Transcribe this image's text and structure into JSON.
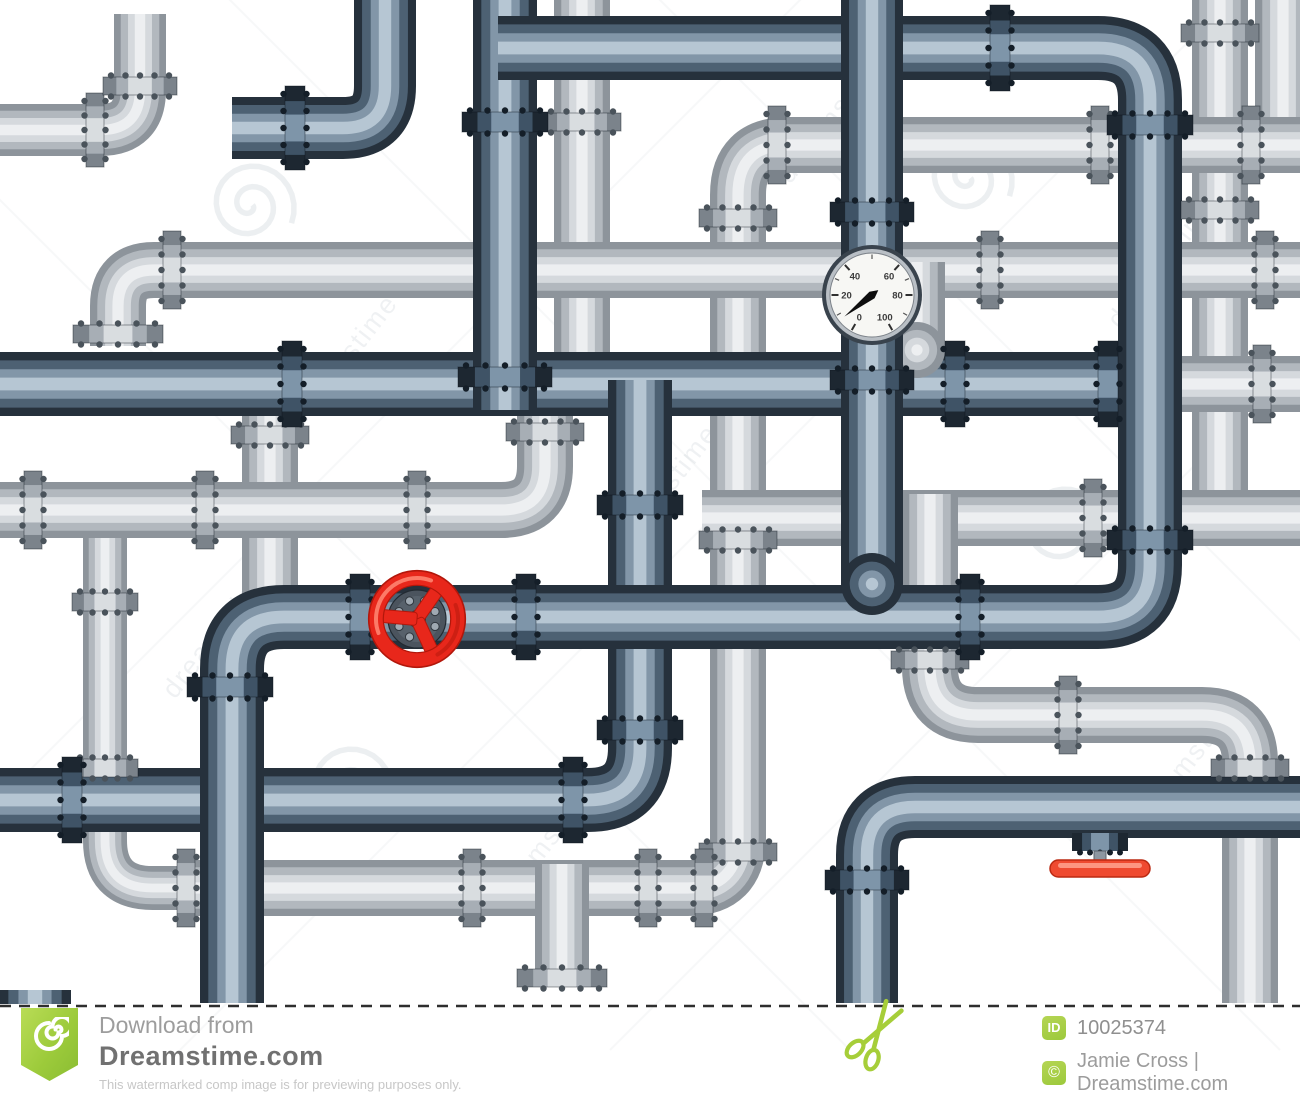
{
  "page_title": "Plumbing pipe maze stock illustration preview",
  "footer": {
    "download_from": "Download from",
    "site_name": "Dreamstime.com",
    "disclaimer": "This watermarked comp image is for previewing purposes only.",
    "id_label": "ID",
    "image_id": "10025374",
    "copyright_symbol": "©",
    "credit": "Jamie Cross | Dreamstime.com"
  },
  "watermark": {
    "text": "dreamstime",
    "color": "#6e8090",
    "text_instances": [
      {
        "x": 300,
        "y": 430,
        "rot": -52
      },
      {
        "x": 175,
        "y": 700,
        "rot": -52
      },
      {
        "x": 1120,
        "y": 330,
        "rot": -52
      },
      {
        "x": 790,
        "y": 185,
        "rot": -52
      },
      {
        "x": 500,
        "y": 915,
        "rot": -52
      },
      {
        "x": 1145,
        "y": 830,
        "rot": -52
      },
      {
        "x": 620,
        "y": 560,
        "rot": -52
      }
    ],
    "spirals": [
      {
        "x": 250,
        "y": 205
      },
      {
        "x": 968,
        "y": 178
      },
      {
        "x": 348,
        "y": 788
      },
      {
        "x": 1062,
        "y": 528
      }
    ],
    "diag_lines": 6
  },
  "palette": {
    "pipe": {
      "D": [
        {
          "f": 1,
          "c": "#26313c"
        },
        {
          "f": 0.74,
          "c": "#4d6173"
        },
        {
          "f": 0.46,
          "c": "#8296a8"
        },
        {
          "f": 0.2,
          "c": "#b6c6d3"
        }
      ],
      "L": [
        {
          "f": 1,
          "c": "#8d949b"
        },
        {
          "f": 0.74,
          "c": "#b2b8be"
        },
        {
          "f": 0.46,
          "c": "#d5d9dd"
        },
        {
          "f": 0.2,
          "c": "#edeff1"
        }
      ]
    },
    "flange": {
      "D": {
        "bands": [
          "#1d2731",
          "#3f5366",
          "#7e95a9"
        ],
        "bolt": "#141e28"
      },
      "L": {
        "bands": [
          "#7b838b",
          "#a7aeb5",
          "#d9dde0"
        ],
        "bolt": "#4a535b"
      }
    }
  },
  "illustration": {
    "pipes": [
      {
        "n": "light-vert-582",
        "t": "L",
        "w": 56,
        "pts": [
          [
            582,
            -30
          ],
          [
            582,
            360
          ]
        ]
      },
      {
        "n": "light-vert-1220",
        "t": "L",
        "w": 56,
        "pts": [
          [
            1220,
            -30
          ],
          [
            1220,
            512
          ]
        ]
      },
      {
        "n": "light-vert-corner-tr",
        "t": "L",
        "w": 56,
        "pts": [
          [
            1283,
            -30
          ],
          [
            1283,
            170
          ]
        ]
      },
      {
        "n": "light-topleft-elbow",
        "t": "L",
        "w": 52,
        "pts": [
          [
            0,
            130
          ],
          [
            140,
            130
          ],
          [
            140,
            14
          ]
        ],
        "r": 40
      },
      {
        "n": "light-hook-left",
        "t": "L",
        "w": 44,
        "pts": [
          [
            105,
            496
          ],
          [
            105,
            888
          ],
          [
            200,
            888
          ]
        ],
        "r": 52
      },
      {
        "n": "light-big-c",
        "t": "L",
        "w": 56,
        "pts": [
          [
            1300,
            145
          ],
          [
            738,
            145
          ],
          [
            738,
            888
          ],
          [
            186,
            888
          ]
        ],
        "r": 50
      },
      {
        "n": "light-h270",
        "t": "L",
        "w": 56,
        "pts": [
          [
            118,
            346
          ],
          [
            118,
            270
          ],
          [
            1300,
            270
          ]
        ],
        "r": 36
      },
      {
        "n": "light-vert-270",
        "t": "L",
        "w": 56,
        "pts": [
          [
            270,
            410
          ],
          [
            270,
            645
          ]
        ]
      },
      {
        "n": "light-h510-elbow-up",
        "t": "L",
        "w": 56,
        "pts": [
          [
            0,
            510
          ],
          [
            545,
            510
          ],
          [
            545,
            404
          ]
        ],
        "r": 44
      },
      {
        "n": "light-h518-right",
        "t": "L",
        "w": 56,
        "pts": [
          [
            702,
            518
          ],
          [
            1300,
            518
          ]
        ]
      },
      {
        "n": "light-s-route",
        "t": "L",
        "w": 56,
        "pts": [
          [
            930,
            494
          ],
          [
            930,
            715
          ],
          [
            1250,
            715
          ],
          [
            1250,
            1003
          ]
        ],
        "r": 48
      },
      {
        "n": "light-stub-down",
        "t": "L",
        "w": 54,
        "pts": [
          [
            562,
            864
          ],
          [
            562,
            970
          ]
        ]
      },
      {
        "n": "light-h384-right",
        "t": "L",
        "w": 56,
        "pts": [
          [
            1146,
            384
          ],
          [
            1300,
            384
          ]
        ]
      },
      {
        "n": "dark-main-384",
        "t": "D",
        "w": 64,
        "pts": [
          [
            0,
            384
          ],
          [
            1152,
            384
          ]
        ]
      },
      {
        "n": "dark-vert640-h800",
        "t": "D",
        "w": 64,
        "pts": [
          [
            640,
            380
          ],
          [
            640,
            800
          ],
          [
            0,
            800
          ]
        ],
        "r": 52
      },
      {
        "n": "light-stub-dome-917",
        "t": "L",
        "w": 56,
        "pts": [
          [
            917,
            262
          ],
          [
            917,
            350
          ]
        ],
        "dome": [
          917,
          350
        ]
      },
      {
        "n": "dark-vert-505",
        "t": "D",
        "w": 64,
        "pts": [
          [
            505,
            -30
          ],
          [
            505,
            410
          ]
        ]
      },
      {
        "n": "dark-grand-route",
        "t": "D",
        "w": 64,
        "pts": [
          [
            498,
            48
          ],
          [
            1150,
            48
          ],
          [
            1150,
            617
          ],
          [
            232,
            617
          ],
          [
            232,
            1003
          ]
        ],
        "r": 52
      },
      {
        "n": "dark-gauge-pipe",
        "t": "D",
        "w": 62,
        "pts": [
          [
            872,
            -40
          ],
          [
            872,
            584
          ]
        ],
        "dome": [
          872,
          584
        ]
      },
      {
        "n": "dark-topleft-elbow",
        "t": "D",
        "w": 62,
        "pts": [
          [
            385,
            -30
          ],
          [
            385,
            128
          ],
          [
            232,
            128
          ]
        ],
        "r": 42
      },
      {
        "n": "dark-bottom-right",
        "t": "D",
        "w": 62,
        "pts": [
          [
            867,
            1003
          ],
          [
            867,
            807
          ],
          [
            1300,
            807
          ]
        ],
        "r": 48
      },
      {
        "n": "dark-pipe-end-bl",
        "t": "D",
        "w": 72,
        "pts": [
          [
            35,
            990
          ],
          [
            35,
            1004
          ]
        ]
      }
    ],
    "flanges": [
      {
        "x": 95,
        "y": 130,
        "o": "h",
        "t": "L",
        "pw": 52
      },
      {
        "x": 140,
        "y": 86,
        "o": "v",
        "t": "L",
        "pw": 52
      },
      {
        "x": 582,
        "y": 122,
        "o": "v",
        "t": "L",
        "pw": 56
      },
      {
        "x": 777,
        "y": 145,
        "o": "h",
        "t": "L",
        "pw": 56
      },
      {
        "x": 1100,
        "y": 145,
        "o": "h",
        "t": "L",
        "pw": 56
      },
      {
        "x": 1251,
        "y": 145,
        "o": "h",
        "t": "L",
        "pw": 56
      },
      {
        "x": 1220,
        "y": 33,
        "o": "v",
        "t": "L",
        "pw": 56
      },
      {
        "x": 1220,
        "y": 210,
        "o": "v",
        "t": "L",
        "pw": 56
      },
      {
        "x": 172,
        "y": 270,
        "o": "h",
        "t": "L",
        "pw": 56
      },
      {
        "x": 990,
        "y": 270,
        "o": "h",
        "t": "L",
        "pw": 56
      },
      {
        "x": 1265,
        "y": 270,
        "o": "h",
        "t": "L",
        "pw": 56
      },
      {
        "x": 738,
        "y": 218,
        "o": "v",
        "t": "L",
        "pw": 56
      },
      {
        "x": 118,
        "y": 334,
        "o": "v",
        "t": "L",
        "pw": 56,
        "b": 34
      },
      {
        "x": 738,
        "y": 540,
        "o": "v",
        "t": "L",
        "pw": 56
      },
      {
        "x": 738,
        "y": 852,
        "o": "v",
        "t": "L",
        "pw": 56
      },
      {
        "x": 105,
        "y": 602,
        "o": "v",
        "t": "L",
        "pw": 44
      },
      {
        "x": 105,
        "y": 768,
        "o": "v",
        "t": "L",
        "pw": 44
      },
      {
        "x": 186,
        "y": 888,
        "o": "h",
        "t": "L",
        "pw": 56
      },
      {
        "x": 472,
        "y": 888,
        "o": "h",
        "t": "L",
        "pw": 56
      },
      {
        "x": 648,
        "y": 888,
        "o": "h",
        "t": "L",
        "pw": 56
      },
      {
        "x": 704,
        "y": 888,
        "o": "h",
        "t": "L",
        "pw": 56
      },
      {
        "x": 270,
        "y": 435,
        "o": "v",
        "t": "L",
        "pw": 56
      },
      {
        "x": 545,
        "y": 432,
        "o": "v",
        "t": "L",
        "pw": 56
      },
      {
        "x": 417,
        "y": 510,
        "o": "h",
        "t": "L",
        "pw": 56
      },
      {
        "x": 33,
        "y": 510,
        "o": "h",
        "t": "L",
        "pw": 56
      },
      {
        "x": 205,
        "y": 510,
        "o": "h",
        "t": "L",
        "pw": 56
      },
      {
        "x": 1093,
        "y": 518,
        "o": "h",
        "t": "L",
        "pw": 56
      },
      {
        "x": 930,
        "y": 660,
        "o": "v",
        "t": "L",
        "pw": 56
      },
      {
        "x": 1068,
        "y": 715,
        "o": "h",
        "t": "L",
        "pw": 56
      },
      {
        "x": 1250,
        "y": 768,
        "o": "v",
        "t": "L",
        "pw": 56
      },
      {
        "x": 562,
        "y": 978,
        "o": "v",
        "t": "L",
        "pw": 54,
        "b": 36
      },
      {
        "x": 1262,
        "y": 384,
        "o": "h",
        "t": "L",
        "pw": 56
      },
      {
        "x": 292,
        "y": 384,
        "o": "h",
        "t": "D",
        "pw": 64
      },
      {
        "x": 955,
        "y": 384,
        "o": "h",
        "t": "D",
        "pw": 64
      },
      {
        "x": 1108,
        "y": 384,
        "o": "h",
        "t": "D",
        "pw": 64
      },
      {
        "x": 505,
        "y": 122,
        "o": "v",
        "t": "D",
        "pw": 64
      },
      {
        "x": 505,
        "y": 377,
        "o": "v",
        "t": "D",
        "pw": 64,
        "b": 30
      },
      {
        "x": 640,
        "y": 505,
        "o": "v",
        "t": "D",
        "pw": 64
      },
      {
        "x": 640,
        "y": 730,
        "o": "v",
        "t": "D",
        "pw": 64
      },
      {
        "x": 573,
        "y": 800,
        "o": "h",
        "t": "D",
        "pw": 64
      },
      {
        "x": 72,
        "y": 800,
        "o": "h",
        "t": "D",
        "pw": 64
      },
      {
        "x": 1000,
        "y": 48,
        "o": "h",
        "t": "D",
        "pw": 64
      },
      {
        "x": 1150,
        "y": 125,
        "o": "v",
        "t": "D",
        "pw": 64
      },
      {
        "x": 1150,
        "y": 540,
        "o": "v",
        "t": "D",
        "pw": 64
      },
      {
        "x": 360,
        "y": 617,
        "o": "h",
        "t": "D",
        "pw": 64
      },
      {
        "x": 526,
        "y": 617,
        "o": "h",
        "t": "D",
        "pw": 64
      },
      {
        "x": 970,
        "y": 617,
        "o": "h",
        "t": "D",
        "pw": 64
      },
      {
        "x": 230,
        "y": 687,
        "o": "v",
        "t": "D",
        "pw": 64
      },
      {
        "x": 872,
        "y": 212,
        "o": "v",
        "t": "D",
        "pw": 62
      },
      {
        "x": 872,
        "y": 380,
        "o": "v",
        "t": "D",
        "pw": 62
      },
      {
        "x": 295,
        "y": 128,
        "o": "h",
        "t": "D",
        "pw": 62
      },
      {
        "x": 867,
        "y": 880,
        "o": "v",
        "t": "D",
        "pw": 62
      }
    ],
    "gauge": {
      "cx": 872,
      "cy": 295,
      "r": 50,
      "labels": [
        {
          "t": "0",
          "a": 210
        },
        {
          "t": "20",
          "a": 270
        },
        {
          "t": "40",
          "a": 318
        },
        {
          "t": "60",
          "a": 42
        },
        {
          "t": "80",
          "a": 90
        },
        {
          "t": "100",
          "a": 150
        }
      ],
      "minor_ticks": [
        240,
        294,
        0,
        66,
        120
      ],
      "needle_angle": 232
    },
    "handwheel": {
      "cx": 417,
      "cy": 619,
      "red": "#e8271b",
      "red_dark": "#b2170b",
      "red_hi": "#ff8a74"
    },
    "lever": {
      "cx": 1100,
      "top": 833,
      "bar": "#ef4a30",
      "bar_hi": "#ffa38f",
      "bar_dark": "#bb2a12"
    },
    "scissors": {
      "x": 880,
      "y": 1028,
      "rot": 32,
      "color": "#a6ce39"
    },
    "cutline": {
      "y": 1006,
      "dash": "11 8",
      "color": "#2e2e2e",
      "w": 2.4
    }
  }
}
